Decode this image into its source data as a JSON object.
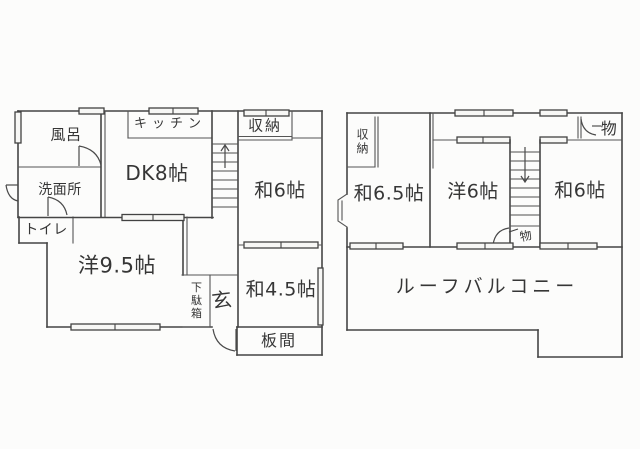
{
  "colors": {
    "paper": "#fcfcfb",
    "ink": "#454545",
    "text": "#363636"
  },
  "floor_left": {
    "labels": {
      "bath": "風呂",
      "kitchen": "キッチン",
      "storage": "収納",
      "dining_kitchen": "DK8帖",
      "washroom": "洗面所",
      "toilet": "トイレ",
      "japanese_6": "和6帖",
      "western_9_5": "洋9.5帖",
      "shoe_cabinet": "下駄箱",
      "entrance": "玄",
      "japanese_4_5": "和4.5帖",
      "wood_floor_room": "板間"
    }
  },
  "floor_right": {
    "labels": {
      "closet": "収納",
      "japanese_6_5": "和6.5帖",
      "western_6": "洋6帖",
      "japanese_6": "和6帖",
      "storage_top": "物",
      "storage_under_stairs": "物",
      "roof_balcony": "ルーフバルコニー"
    }
  }
}
